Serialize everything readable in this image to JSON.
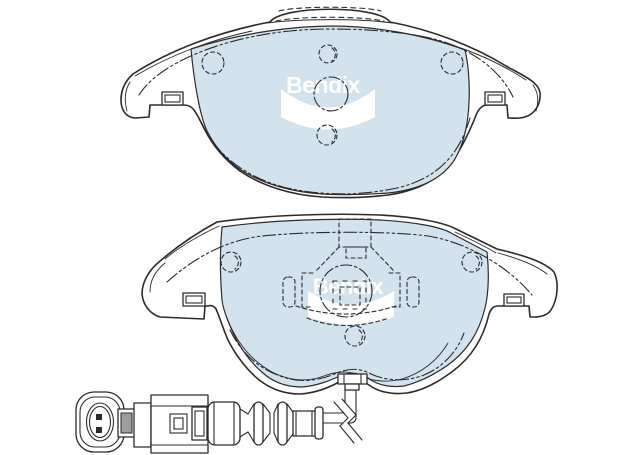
{
  "canvas": {
    "width": 639,
    "height": 455,
    "background": "#ffffff"
  },
  "colors": {
    "outline": "#2b2b2b",
    "friction_material": "#d2e3ee",
    "logo": "#ffffff",
    "connector_shade": "#9d9d9d",
    "background": "#ffffff"
  },
  "upper_pad": {
    "logo_text": "Bendix"
  },
  "lower_pad": {
    "logo_text": "Bendix"
  }
}
